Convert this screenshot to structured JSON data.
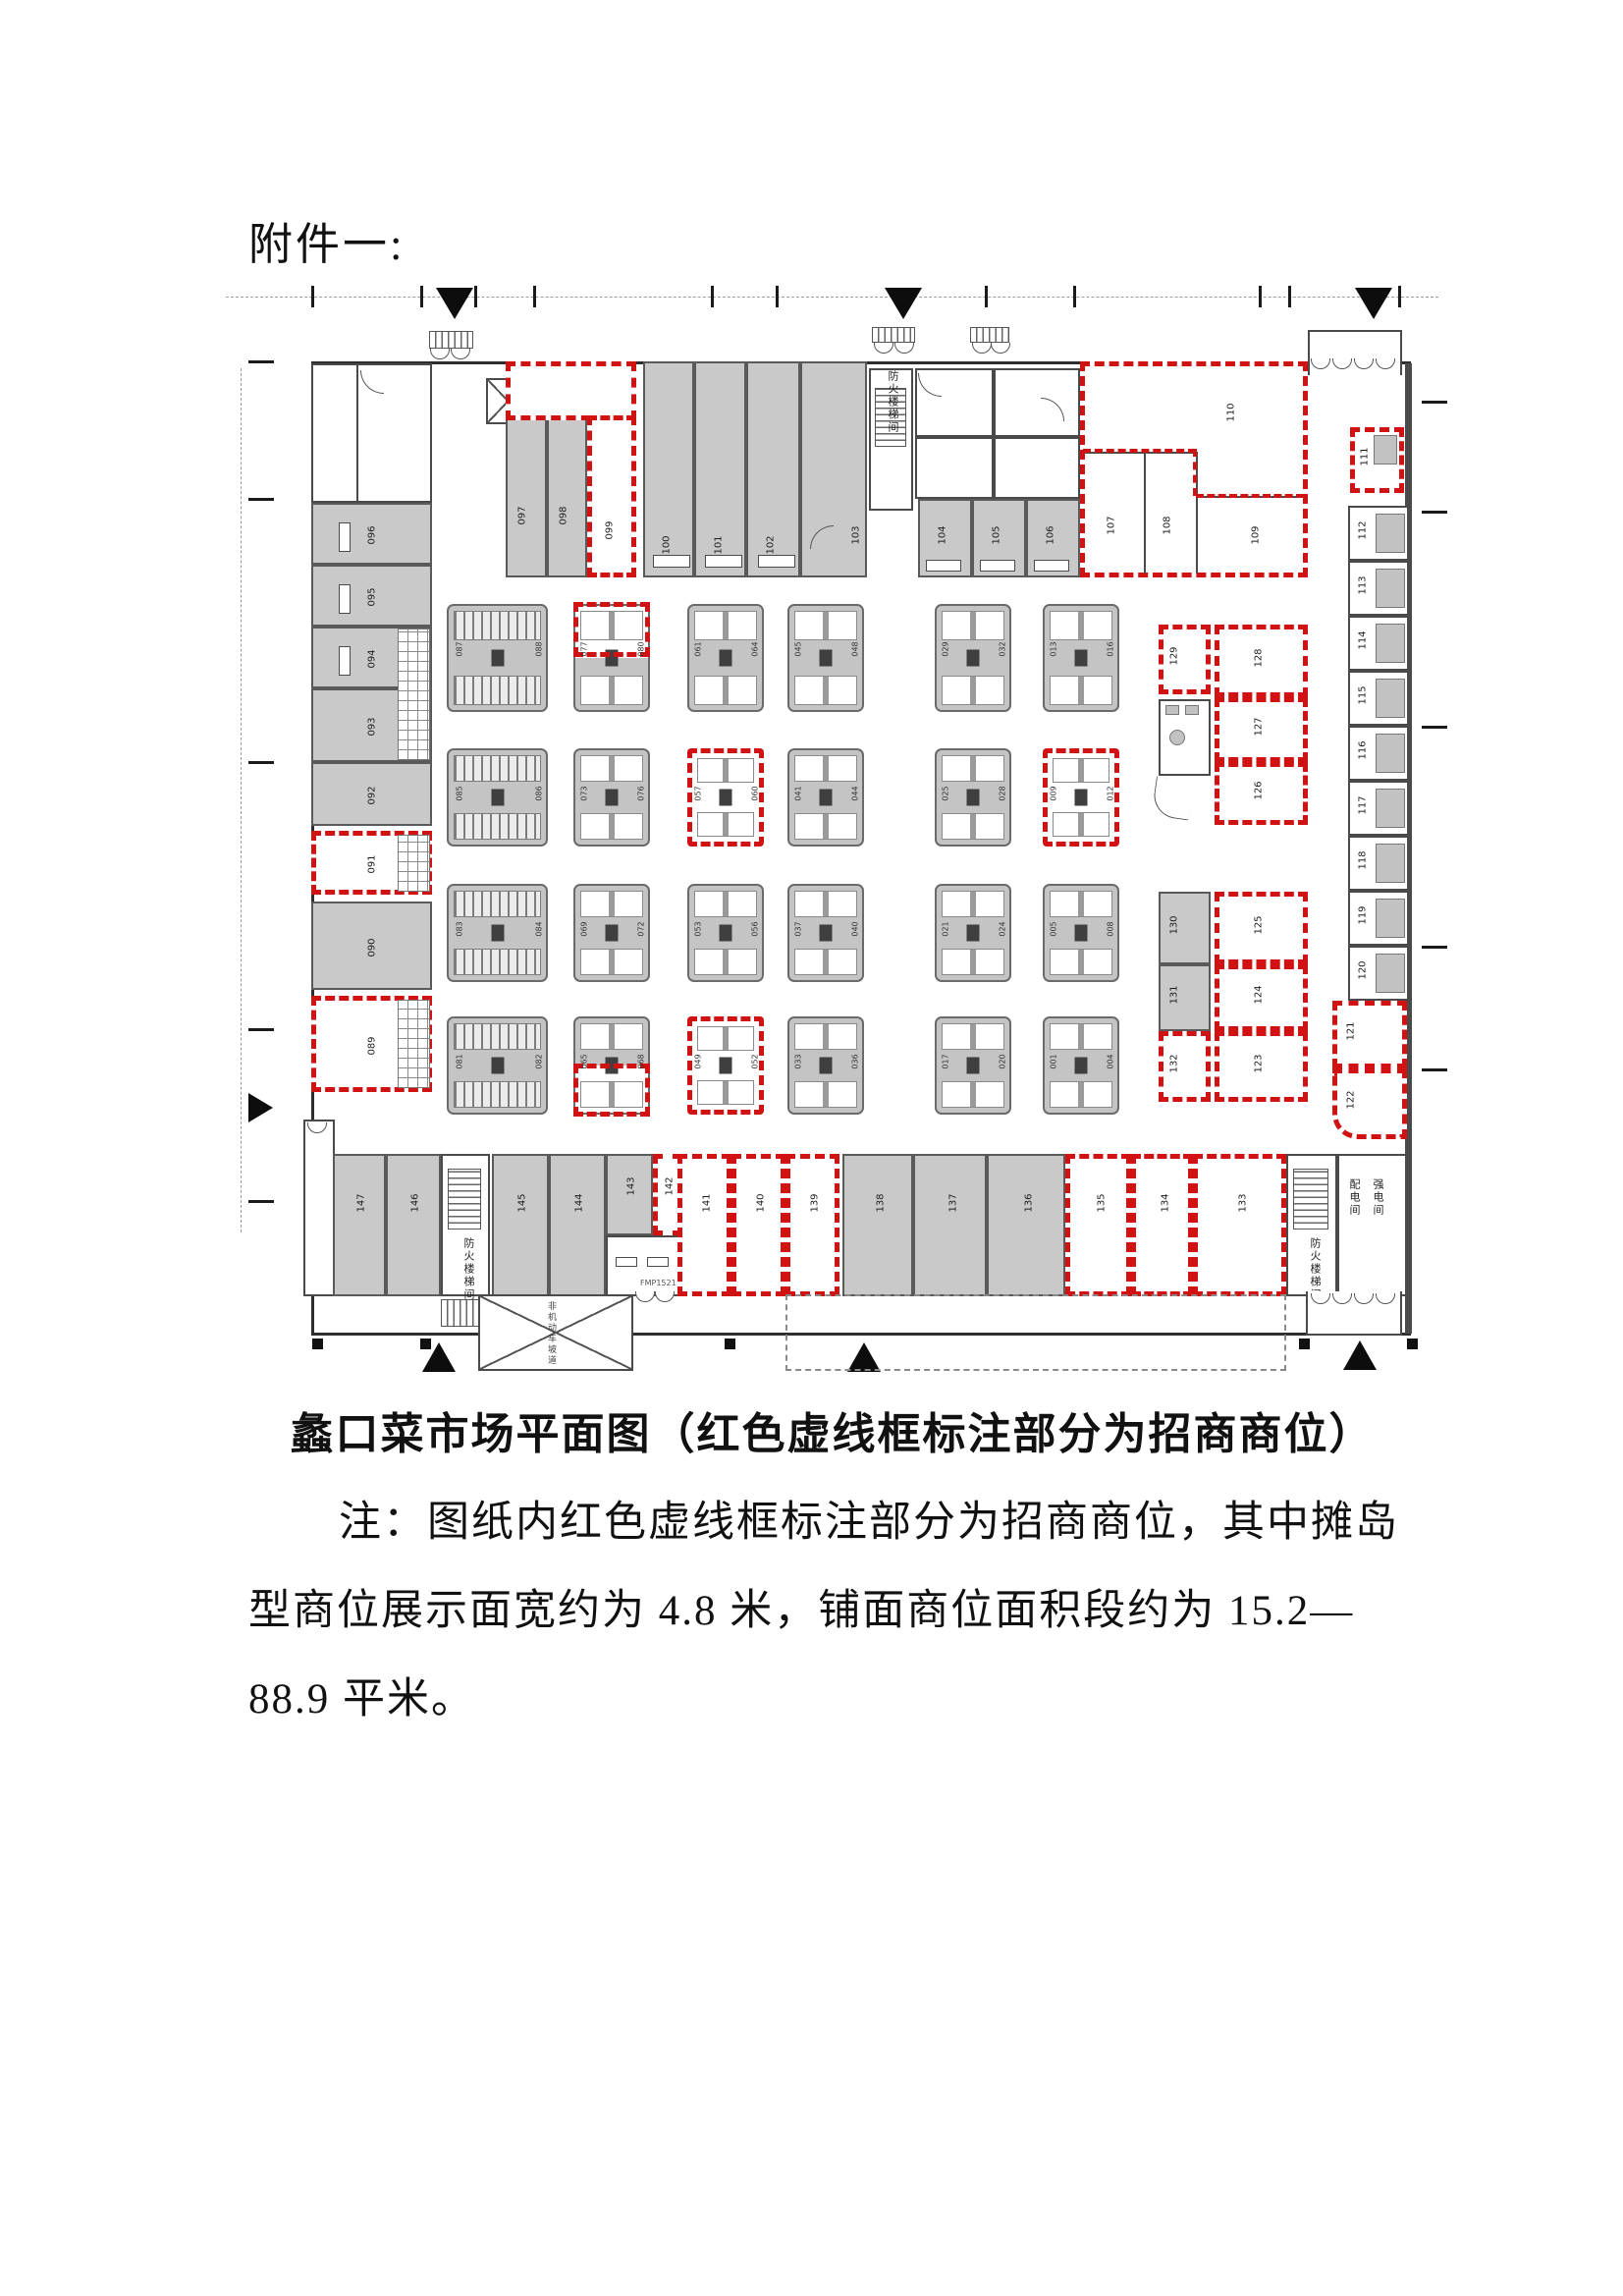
{
  "page": {
    "attachment_label": "附件一:",
    "caption": "蠡口菜市场平面图（红色虚线框标注部分为招商商位）",
    "notes": [
      "注：图纸内红色虚线框标注部分为招商商位，其中摊岛",
      "型商位展示面宽约为 4.8 米，铺面商位面积段约为 15.2—",
      "88.9 平米。"
    ]
  },
  "colors": {
    "highlight_red": "#d11212",
    "stall_gray": "#c9c9c9"
  },
  "plan": {
    "top_row": [
      "097",
      "098",
      "099",
      "100",
      "101",
      "102",
      "103",
      "104",
      "105",
      "106"
    ],
    "suite": [
      "107",
      "108",
      "109",
      "110",
      "111"
    ],
    "right_col": [
      "112",
      "113",
      "114",
      "115",
      "116",
      "117",
      "118",
      "119",
      "120",
      "121",
      "122"
    ],
    "mid_right_upper": [
      "129",
      "128",
      "127",
      "126"
    ],
    "mid_right_lower": [
      "130",
      "131",
      "132",
      "125",
      "124",
      "123"
    ],
    "left_col": [
      "096",
      "095",
      "094",
      "093",
      "092",
      "091",
      "090",
      "089"
    ],
    "bottom_row": [
      "147",
      "146",
      "145",
      "144",
      "143",
      "142",
      "141",
      "140",
      "139",
      "138",
      "137",
      "136",
      "135",
      "134",
      "133"
    ],
    "islands": {
      "a": [
        [
          "087",
          "088"
        ],
        [
          "077",
          "080"
        ],
        [
          "061",
          "064"
        ],
        [
          "045",
          "048"
        ],
        [
          "029",
          "032"
        ],
        [
          "013",
          "016"
        ]
      ],
      "b": [
        [
          "085",
          "086"
        ],
        [
          "073",
          "076"
        ],
        [
          "057",
          "060"
        ],
        [
          "041",
          "044"
        ],
        [
          "025",
          "028"
        ],
        [
          "009",
          "012"
        ]
      ],
      "c": [
        [
          "083",
          "084"
        ],
        [
          "069",
          "072"
        ],
        [
          "053",
          "056"
        ],
        [
          "037",
          "040"
        ],
        [
          "021",
          "024"
        ],
        [
          "005",
          "008"
        ]
      ],
      "d": [
        [
          "081",
          "082"
        ],
        [
          "065",
          "068"
        ],
        [
          "049",
          "052"
        ],
        [
          "033",
          "036"
        ],
        [
          "017",
          "020"
        ],
        [
          "001",
          "004"
        ]
      ]
    },
    "texts": {
      "stairwell": "防火楼梯间",
      "power_room": "配电间",
      "strong_power_room": "强电间",
      "ramp": "非机动车坡道",
      "fire_door": "FMP1521"
    }
  }
}
